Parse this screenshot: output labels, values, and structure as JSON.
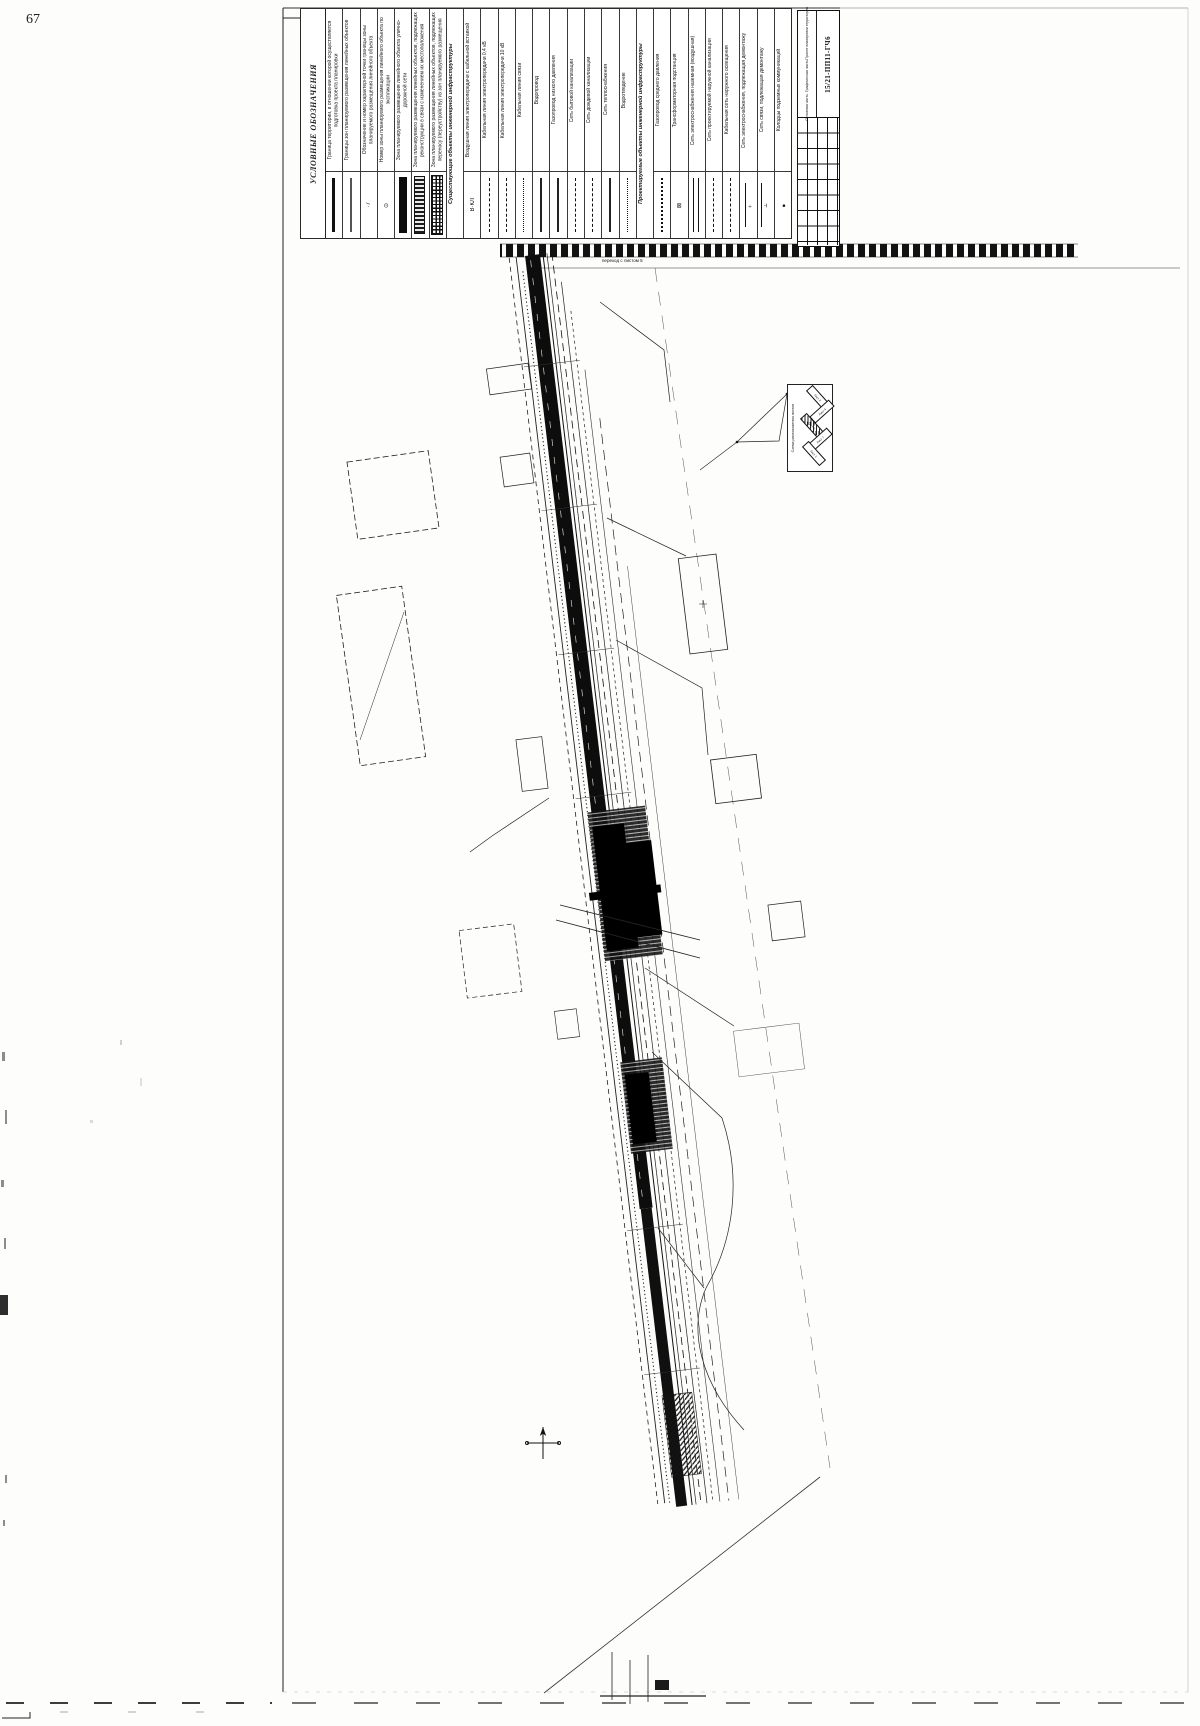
{
  "page": {
    "number": "67"
  },
  "colors": {
    "ink": "#111111",
    "paper": "#fdfdfc"
  },
  "legend": {
    "title": "УСЛОВНЫЕ ОБОЗНАЧЕНИЯ",
    "entries": [
      {
        "sym": "s-thick",
        "cls": "",
        "glyph": "",
        "label": "Граница территории, в отношении которой осуществляется подготовка проекта планировки"
      },
      {
        "sym": "s-thin2",
        "cls": "",
        "glyph": "",
        "label": "Границы зон планируемого размещения линейных объектов"
      },
      {
        "sym": "s-pt",
        "cls": "",
        "glyph": "·7",
        "label": "Обозначение и номер характерной точки границы зоны планируемого размещения линейного объекта"
      },
      {
        "sym": "s-circ",
        "cls": "",
        "glyph": "⊙",
        "label": "Номер зоны планируемого размещения линейного объекта по экспликации"
      },
      {
        "sym": "s-band",
        "cls": "",
        "glyph": "",
        "label": "Зона планируемого размещения линейного объекта улично-дорожной сети"
      },
      {
        "sym": "s-hatch",
        "cls": "",
        "glyph": "",
        "label": "Зона планируемого размещения линейных объектов, подлежащих реконструкции в связи с изменением их местоположения"
      },
      {
        "sym": "s-cross",
        "cls": "",
        "glyph": "",
        "label": "Зона планируемого размещения линейных объектов, подлежащих переносу (переустройству) из зон планируемого размещения"
      },
      {
        "sym": "s-none",
        "cls": "section",
        "glyph": "",
        "label": "Существующие объекты инженерной инфраструктуры"
      },
      {
        "sym": "s-code",
        "cls": "",
        "glyph": "В·КЛ",
        "label": "Воздушная линия электропередачи с кабельной вставкой"
      },
      {
        "sym": "s-dash",
        "cls": "",
        "glyph": "",
        "label": "Кабельная линия электропередачи 0,4 кВ"
      },
      {
        "sym": "s-dash",
        "cls": "",
        "glyph": "",
        "label": "Кабельная линия электропередачи 10 кВ"
      },
      {
        "sym": "s-dot",
        "cls": "",
        "glyph": "",
        "label": "Кабельная линия связи"
      },
      {
        "sym": "s-thin",
        "cls": "",
        "glyph": "",
        "label": "Водопровод"
      },
      {
        "sym": "s-thin",
        "cls": "",
        "glyph": "",
        "label": "Газопровод низкого давления"
      },
      {
        "sym": "s-dash",
        "cls": "",
        "glyph": "",
        "label": "Сеть бытовой канализации"
      },
      {
        "sym": "s-dash",
        "cls": "",
        "glyph": "",
        "label": "Сеть дождевой канализации"
      },
      {
        "sym": "s-thin",
        "cls": "",
        "glyph": "",
        "label": "Сеть теплоснабжения"
      },
      {
        "sym": "s-dot",
        "cls": "",
        "glyph": "",
        "label": "Водоотведение"
      },
      {
        "sym": "s-none",
        "cls": "section",
        "glyph": "",
        "label": "Проектируемые объекты инженерной инфраструктуры"
      },
      {
        "sym": "s-dense",
        "cls": "",
        "glyph": "",
        "label": "Газопровод среднего давления"
      },
      {
        "sym": "s-box",
        "cls": "",
        "glyph": "⊠",
        "label": "Трансформаторная подстанция"
      },
      {
        "sym": "s-dbl",
        "cls": "",
        "glyph": "",
        "label": "Сеть электроснабжения наземная (воздушная)"
      },
      {
        "sym": "s-dash",
        "cls": "",
        "glyph": "",
        "label": "Сеть проектируемой наружной канализации"
      },
      {
        "sym": "s-dashdot",
        "cls": "",
        "glyph": "",
        "label": "Кабельная сеть наружного освещения"
      },
      {
        "sym": "s-tick",
        "cls": "",
        "glyph": "÷",
        "label": "Сеть электроснабжения, подлежащая демонтажу"
      },
      {
        "sym": "s-tick",
        "cls": "",
        "glyph": "∸",
        "label": "Сеть связи, подлежащая демонтажу"
      },
      {
        "sym": "s-blackdot",
        "cls": "",
        "glyph": "●",
        "label": "Колодцы подземных коммуникаций"
      }
    ]
  },
  "stamp": {
    "number": "15/21-ПП11-ГЧ6",
    "line1": "Проект планировки территории",
    "line2": "Основная часть. Графическая часть"
  },
  "inset": {
    "caption": "Схема расположения листов",
    "sheets": [
      {
        "label": "Лист 2",
        "cls": ""
      },
      {
        "label": "Лист 4",
        "cls": ""
      },
      {
        "label": "Лист 6",
        "cls": "cur"
      },
      {
        "label": "Лист 7",
        "cls": ""
      },
      {
        "label": "Лист 1",
        "cls": ""
      }
    ]
  },
  "plan": {
    "annotation_top": "переход с листом 5"
  }
}
